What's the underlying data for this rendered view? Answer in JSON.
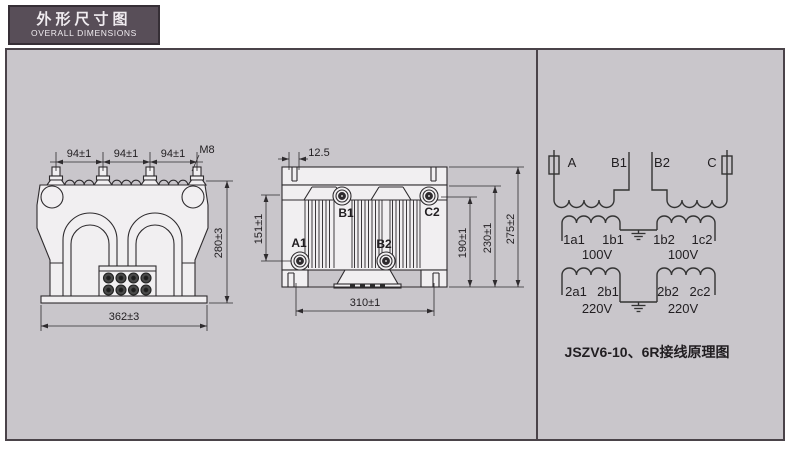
{
  "header": {
    "title_zh": "外形尺寸图",
    "title_en": "OVERALL DIMENSIONS"
  },
  "front_view": {
    "dim_pitch_1": "94±1",
    "dim_pitch_2": "94±1",
    "dim_pitch_3": "94±1",
    "thread_label": "M8",
    "dim_height": "280±3",
    "dim_width": "362±3"
  },
  "side_view": {
    "dim_offset": "12.5",
    "dim_a1_height": "151±1",
    "dim_h1": "190±1",
    "dim_h2": "230±1",
    "dim_h3": "275±2",
    "dim_mounting": "310±1",
    "terminals": {
      "a1": "A1",
      "b1": "B1",
      "b2": "B2",
      "c2": "C2"
    }
  },
  "schematic": {
    "primary": {
      "a": "A",
      "b1": "B1",
      "b2": "B2",
      "c": "C"
    },
    "secondary_100v": {
      "t1": "1a1",
      "t2": "1b1",
      "t3": "1b2",
      "t4": "1c2",
      "v1": "100V",
      "v2": "100V"
    },
    "secondary_220v": {
      "t1": "2a1",
      "t2": "2b1",
      "t3": "2b2",
      "t4": "2c2",
      "v1": "220V",
      "v2": "220V"
    },
    "caption": "JSZV6-10、6R接线原理图"
  },
  "colors": {
    "header_bg": "#584e58",
    "header_border": "#362f36",
    "panel_bg": "#c9c6cb",
    "panel_border": "#4a4349",
    "line": "#2e2b2e",
    "body_fill": "#f1eff1"
  }
}
